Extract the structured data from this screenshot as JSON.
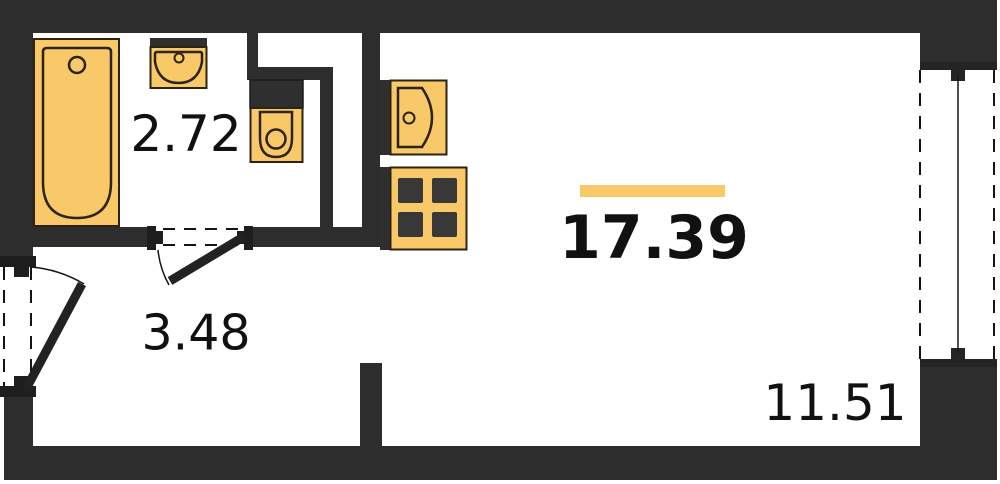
{
  "plan": {
    "title": "studio-apartment-floor-plan",
    "rooms": [
      {
        "id": "bathroom",
        "area_label": "2.72"
      },
      {
        "id": "hallway",
        "area_label": "3.48"
      },
      {
        "id": "living-room",
        "area_label": "17.39"
      },
      {
        "id": "balcony",
        "area_label": "11.51"
      }
    ],
    "fixtures": [
      "bathtub",
      "bathroom-sink",
      "toilet",
      "kitchen-sink",
      "stove",
      "entry-door",
      "bathroom-door",
      "balcony-window"
    ],
    "colors": {
      "wall": "#2d2d2d",
      "fixture_fill": "#f9c869",
      "fixture_outline": "#2b2414",
      "accent_bar": "#f9c869",
      "label_text": "#111111",
      "background": "#ffffff"
    }
  }
}
